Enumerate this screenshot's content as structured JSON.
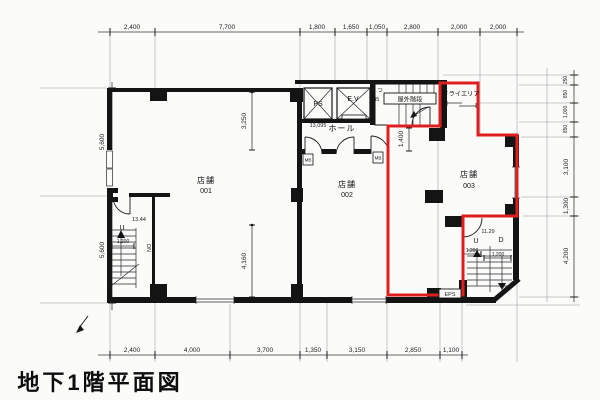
{
  "title": "地下1階平面図",
  "colors": {
    "unit_outline_red": "#df1f1f",
    "wall_black": "#141414"
  },
  "rooms": {
    "shop1": {
      "label": "店舗",
      "number": "001"
    },
    "shop2": {
      "label": "店舗",
      "number": "002"
    },
    "shop3": {
      "label": "店舗",
      "number": "003"
    },
    "hall": "ホール",
    "ps": "PS",
    "elevator": "E.V",
    "outdoor_stair": "屋外階段",
    "dry_area": "ドライエリア"
  },
  "dimensions": {
    "top": [
      "2,400",
      "7,700",
      "1,800",
      "1,650",
      "1,050",
      "2,800",
      "2,000",
      "2,000"
    ],
    "bottom": [
      "2,400",
      "4,000",
      "3,700",
      "1,350",
      "3,150",
      "2,850",
      "1,100"
    ],
    "left": [
      "5,600",
      "5,600"
    ],
    "right": [
      "250",
      "850",
      "1,000",
      "850",
      "3,100",
      "1,300",
      "4,200"
    ],
    "interior": {
      "shop1_upper": "3,250",
      "shop1_lower": "4,160",
      "shop3_entry": "1,400",
      "hall_level": "13,095",
      "outdoor_stair_area": "7.35",
      "stair_left_level": "13.44",
      "stair_right_level": "11.29",
      "stair_left_width": "1,200",
      "stair_right_width_a": "1,200",
      "stair_right_width_b": "1,200"
    }
  },
  "annotations": {
    "up": "U",
    "down": "D",
    "down_note": "DN",
    "meter_box": "MB",
    "eps": "EPS",
    "tsu": "つ"
  }
}
